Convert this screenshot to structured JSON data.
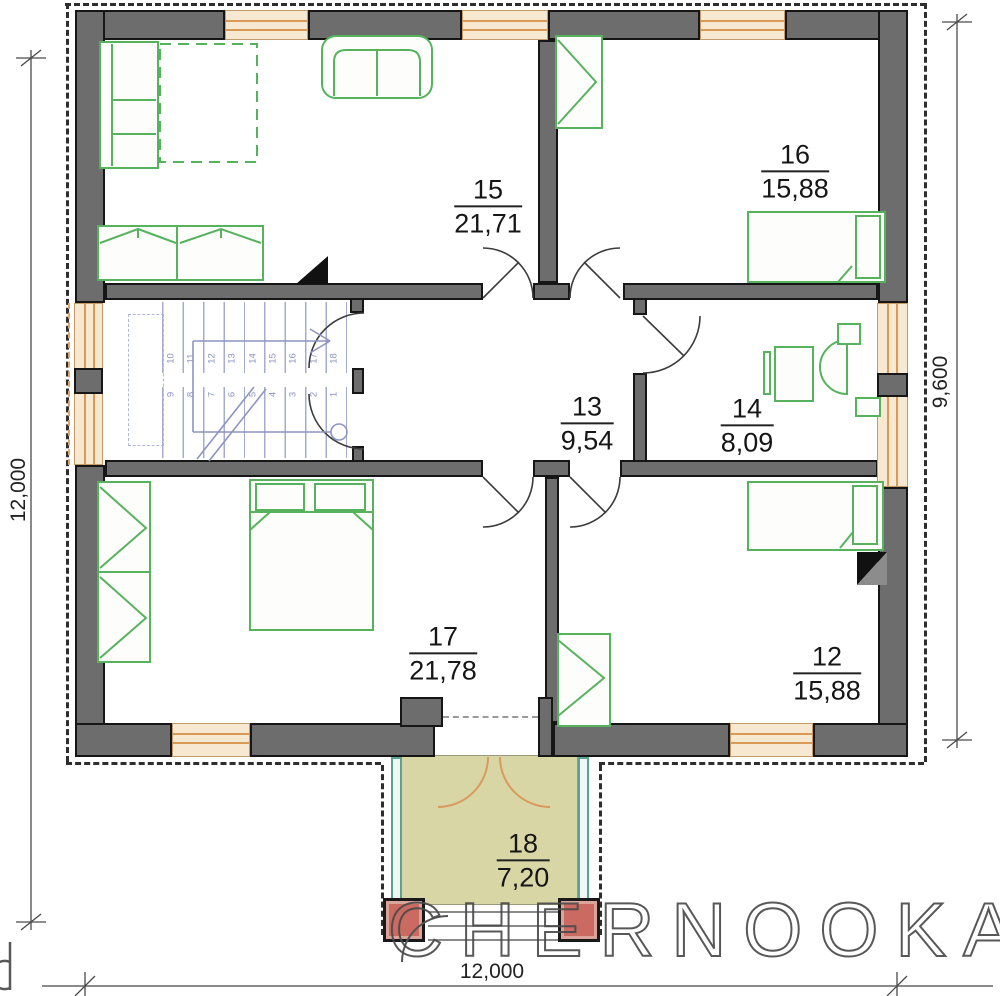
{
  "watermark": {
    "text": "CHERNOOKA",
    "edge_fragment": "a"
  },
  "dimensions": {
    "left_vertical": "12,000",
    "bottom_horizontal": "12,000",
    "right_vertical": "9,600"
  },
  "rooms": [
    {
      "number": "15",
      "area": "21,71"
    },
    {
      "number": "16",
      "area": "15,88"
    },
    {
      "number": "13",
      "area": "9,54"
    },
    {
      "number": "14",
      "area": "8,09"
    },
    {
      "number": "17",
      "area": "21,78"
    },
    {
      "number": "12",
      "area": "15,88"
    },
    {
      "number": "18",
      "area": "7,20"
    }
  ],
  "stairs": {
    "upper_run_steps": [
      "10",
      "11",
      "12",
      "13",
      "14",
      "15",
      "16",
      "17",
      "18"
    ],
    "lower_run_steps": [
      "9",
      "8",
      "7",
      "6",
      "5",
      "4",
      "3",
      "2",
      "1"
    ]
  },
  "colors": {
    "wall": "#6d6d6d",
    "window_frame": "#da9a55",
    "furniture": "#57b25e",
    "stair_marks": "#8d94c2",
    "porch_floor": "#d9d6a6",
    "column": "#cb6a60",
    "railing": "#5aa392",
    "watermark": "#4a4a4a"
  }
}
